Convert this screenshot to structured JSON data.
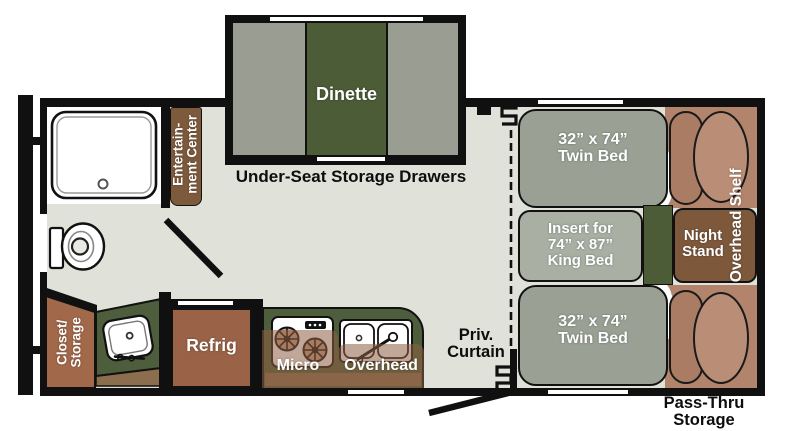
{
  "labels": {
    "dinette": "Dinette",
    "under_seat": "Under-Seat Storage Drawers",
    "ent_center": [
      "Entertain-",
      "ment Center"
    ],
    "closet": [
      "Closet/",
      "Storage"
    ],
    "refrig": "Refrig",
    "micro": "Micro",
    "overhead": "Overhead",
    "priv_curtain": [
      "Priv.",
      "Curtain"
    ],
    "bed_top": [
      "32” x 74”",
      "Twin Bed"
    ],
    "bed_bottom": [
      "32” x 74”",
      "Twin Bed"
    ],
    "king_insert": [
      "Insert for",
      "74” x 87”",
      "King Bed"
    ],
    "night_stand": [
      "Night",
      "Stand"
    ],
    "overhead_shelf": "Overhead Shelf",
    "pass_thru": [
      "Pass-Thru",
      "Storage"
    ]
  },
  "colors": {
    "floor": "#e0e1d8",
    "wall": "#101010",
    "dinette_bench": "#9a9e92",
    "dinette_table_green": "#4b5c36",
    "counter_green": "#4e5e3c",
    "entertainment_brown": "#7d5a3c",
    "closet_brown": "#a2684a",
    "refrig_brown": "#9a6247",
    "night_stand_brown": "#7d583b",
    "cabinet_tan": "#8a6e4e",
    "bed_gray": "#9aa094",
    "insert_gray": "#a9afa3",
    "pillow_area_salmon": "#b2846b",
    "pillow_light": "#ba8e76",
    "pillow_dark": "#ab7c64",
    "overlay_translucent_brown": "rgba(140,95,65,0.55)"
  }
}
